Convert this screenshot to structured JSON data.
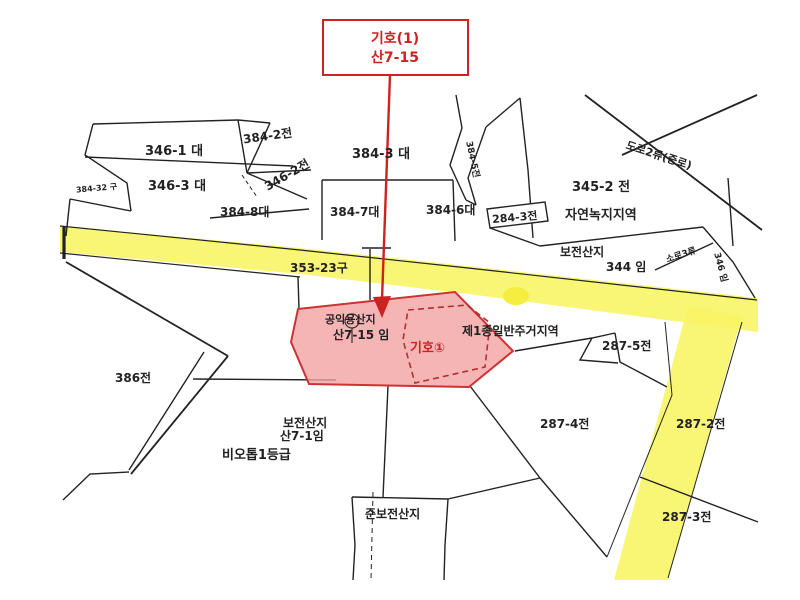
{
  "map": {
    "callout": {
      "line1": "기호(1)",
      "line2": "산7-15"
    },
    "labels": {
      "p346_1": "346-1 대",
      "p384_2": "384-2전",
      "p346_3": "346-3 대",
      "p346_2": "346-2전",
      "p384_3": "384-3 대",
      "p384_8": "384-8대",
      "p384_7": "384-7대",
      "p384_6": "384-6대",
      "p384_5": "384-5전",
      "p284_3": "284-3전",
      "p345_2": "345-2 전",
      "zone_nature": "자연녹지지역",
      "road2": "도로2류(중로)",
      "p384_32": "384-32 구",
      "p353_23": "353-23구",
      "bojeon_upper": "보전산지",
      "p344": "344 임",
      "soro3": "소로3류",
      "p346_im": "346 임",
      "pink_line1": "공익용산지",
      "pink_line2": "산7-15 임",
      "pink_giho": "기호①",
      "zone_res": "제1종일반주거지역",
      "p287_5": "287-5전",
      "p386": "386전",
      "bojeon_lower1": "보전산지",
      "bojeon_lower2": "산7-1임",
      "biotope": "비오톱1등급",
      "p287_4": "287-4전",
      "p287_2": "287-2전",
      "p287_3": "287-3전",
      "jun_bojeon": "준보전산지"
    },
    "colors": {
      "highlight_red": "#cc2222",
      "parcel_fill": "#f2a2a2",
      "road_yellow": "#f8f566",
      "line": "#222222"
    }
  }
}
